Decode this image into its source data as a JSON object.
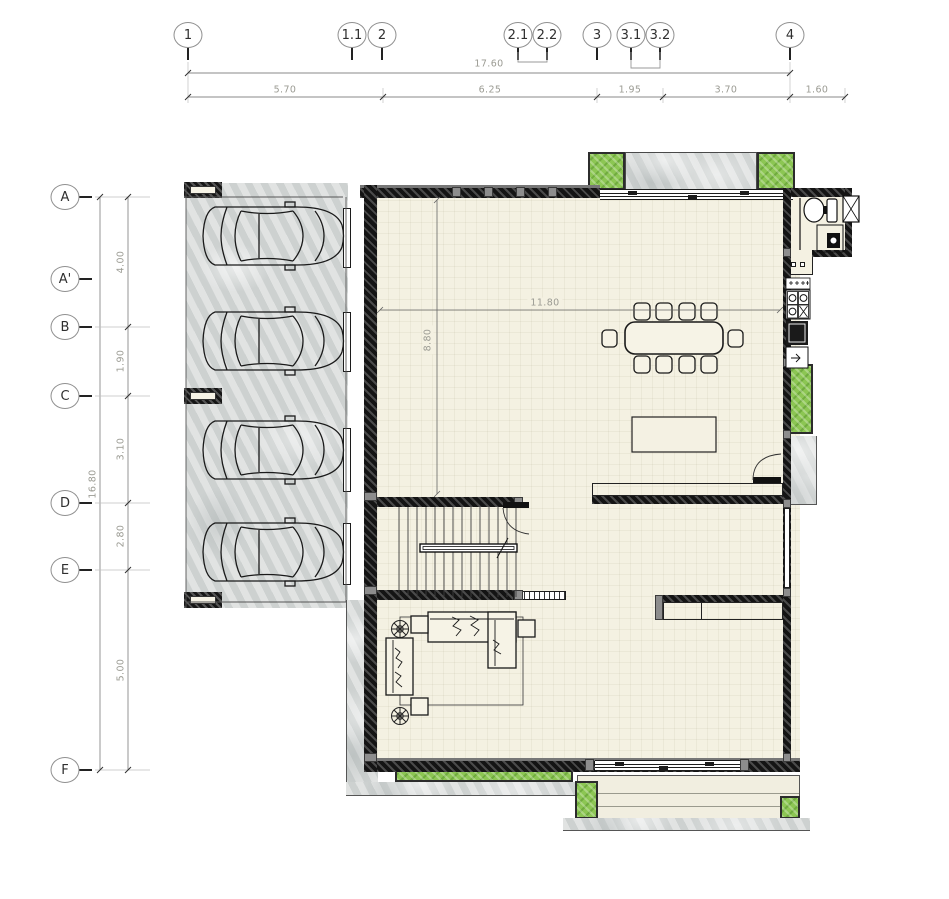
{
  "drawing": {
    "type": "architectural-floor-plan",
    "view": "ground-floor"
  },
  "grid": {
    "top": [
      {
        "label": "1"
      },
      {
        "label": "1.1"
      },
      {
        "label": "2"
      },
      {
        "label": "2.1"
      },
      {
        "label": "2.2"
      },
      {
        "label": "3"
      },
      {
        "label": "3.1"
      },
      {
        "label": "3.2"
      },
      {
        "label": "4"
      }
    ],
    "left": [
      {
        "label": "A"
      },
      {
        "label": "A'"
      },
      {
        "label": "B"
      },
      {
        "label": "C"
      },
      {
        "label": "D"
      },
      {
        "label": "E"
      },
      {
        "label": "F"
      }
    ]
  },
  "dimensions": {
    "top": {
      "total": "17.60",
      "segments": [
        "5.70",
        "6.25",
        "1.95",
        "3.70",
        "1.60"
      ]
    },
    "left": {
      "total": "16.80",
      "segments": [
        "4.00",
        "1.90",
        "3.10",
        "2.80",
        "5.00"
      ]
    },
    "interior": {
      "width": "11.80",
      "depth": "8.80"
    }
  },
  "symbols": {
    "car": "top-view sedan, 4 in carport",
    "dining_table": "10-seat table",
    "island": "kitchen island",
    "stairs": "double-flight stair",
    "sofa": "sectional sofa + loveseat",
    "plant": "potted plant",
    "toilet": "wc",
    "shower": "shower tray",
    "cooktop": "4-burner hob",
    "oven": "oven",
    "planting": "planter strip"
  },
  "colors": {
    "floor_tile": "#f4f1e2",
    "concrete": "#d7dad9",
    "planting_green": "#8cc653",
    "wall": "#141414",
    "dimension_text": "#9b9b93"
  }
}
